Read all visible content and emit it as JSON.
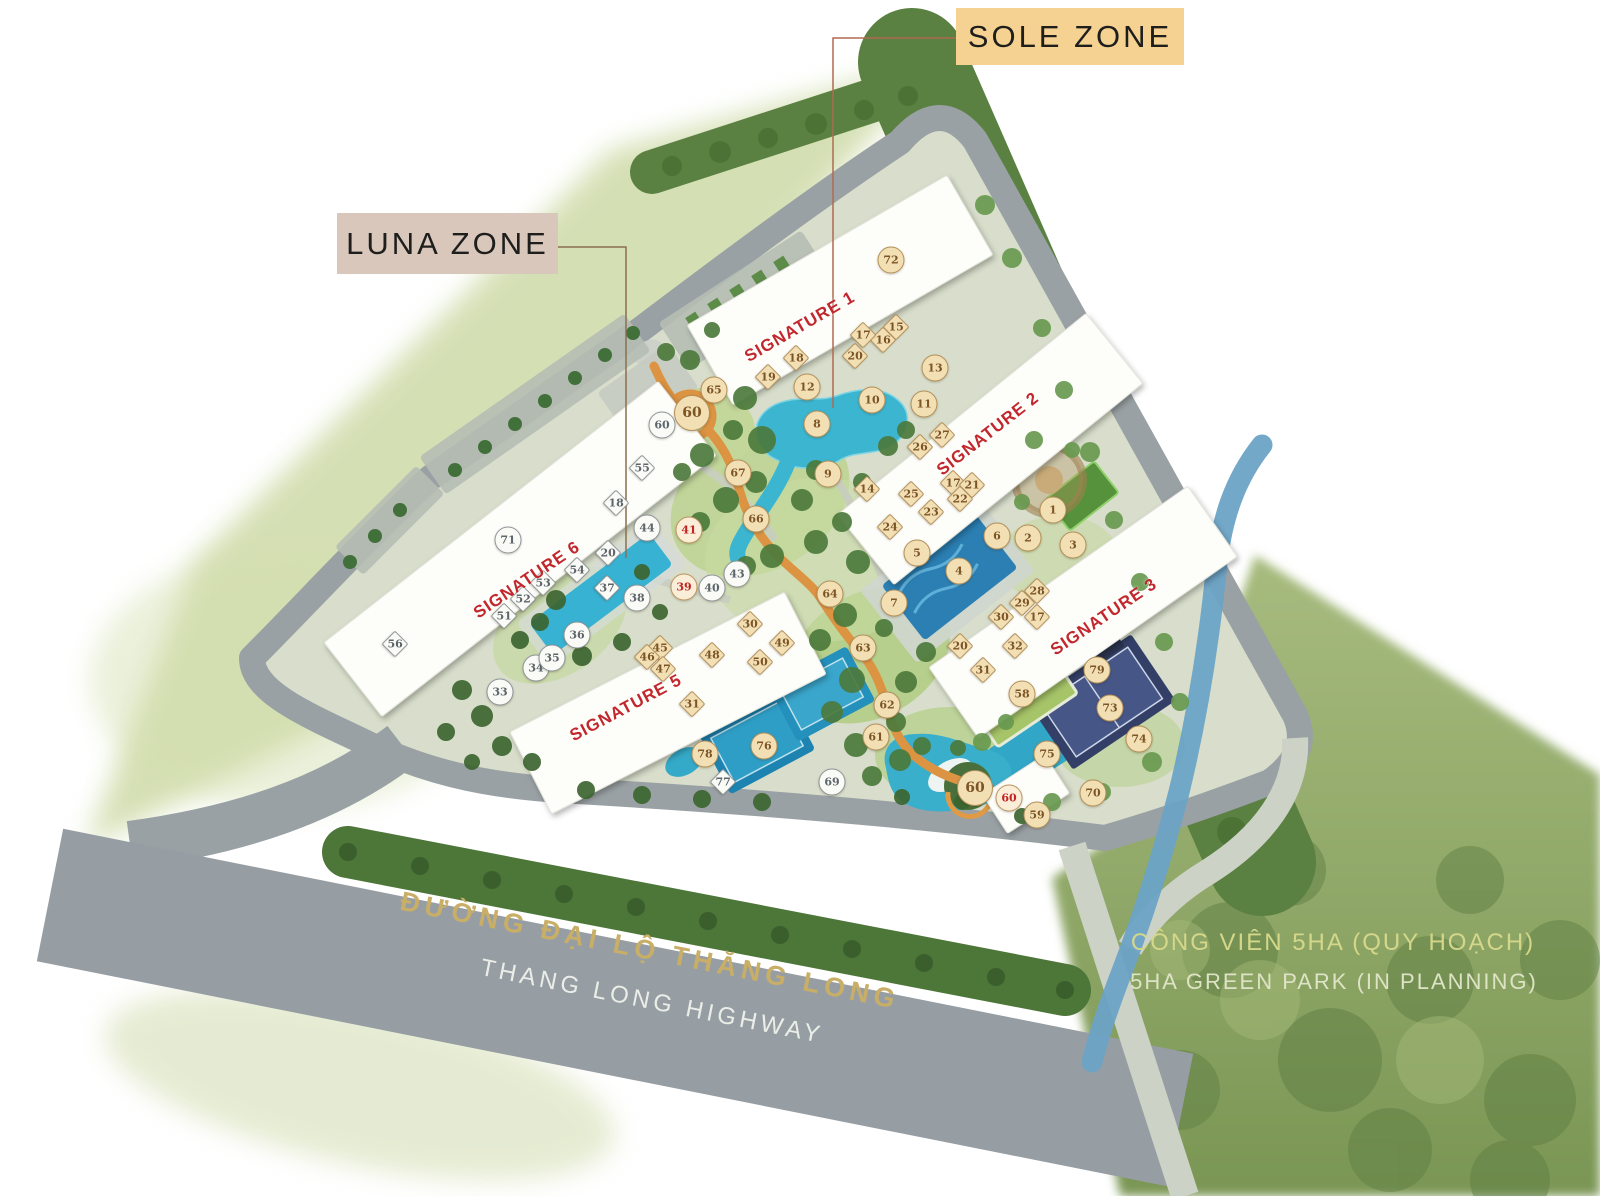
{
  "zones": {
    "sole": "SOLE ZONE",
    "luna": "LUNA ZONE"
  },
  "roads": {
    "highway_vi": "ĐƯỜNG ĐẠI LỘ THĂNG LONG",
    "highway_en": "THANG LONG HIGHWAY"
  },
  "park": {
    "name_vi": "CÔNG VIÊN 5HA (QUY HOẠCH)",
    "name_en": "5HA GREEN PARK (IN PLANNING)"
  },
  "colors": {
    "zone_sole_bg": "#f6d292",
    "zone_luna_bg": "#d9c7bc",
    "signature_red": "#c1272d",
    "road_gold": "#c8ae66",
    "park_text": "#d4d78a",
    "marker_tan": "#f3dfb4",
    "marker_white": "#fafaf7",
    "marker_red_text": "#c32222",
    "track_orange": "#dc9342"
  },
  "building_labels": [
    {
      "text": "SIGNATURE 1",
      "x": 800,
      "y": 327,
      "rot": -30
    },
    {
      "text": "SIGNATURE 2",
      "x": 988,
      "y": 434,
      "rot": -38
    },
    {
      "text": "SIGNATURE 3",
      "x": 1104,
      "y": 617,
      "rot": -34
    },
    {
      "text": "SIGNATURE 5",
      "x": 626,
      "y": 708,
      "rot": -28
    },
    {
      "text": "SIGNATURE 6",
      "x": 527,
      "y": 580,
      "rot": -34
    }
  ],
  "markers": [
    {
      "n": "1",
      "x": 1053,
      "y": 510,
      "s": "c",
      "v": "t"
    },
    {
      "n": "2",
      "x": 1028,
      "y": 538,
      "s": "c",
      "v": "t"
    },
    {
      "n": "3",
      "x": 1073,
      "y": 545,
      "s": "c",
      "v": "t"
    },
    {
      "n": "4",
      "x": 959,
      "y": 571,
      "s": "c",
      "v": "t"
    },
    {
      "n": "5",
      "x": 917,
      "y": 553,
      "s": "c",
      "v": "t"
    },
    {
      "n": "6",
      "x": 997,
      "y": 536,
      "s": "c",
      "v": "t"
    },
    {
      "n": "7",
      "x": 894,
      "y": 603,
      "s": "c",
      "v": "t"
    },
    {
      "n": "8",
      "x": 817,
      "y": 424,
      "s": "c",
      "v": "t"
    },
    {
      "n": "9",
      "x": 828,
      "y": 474,
      "s": "c",
      "v": "t"
    },
    {
      "n": "10",
      "x": 872,
      "y": 400,
      "s": "c",
      "v": "t"
    },
    {
      "n": "11",
      "x": 924,
      "y": 404,
      "s": "c",
      "v": "t"
    },
    {
      "n": "12",
      "x": 807,
      "y": 387,
      "s": "c",
      "v": "t"
    },
    {
      "n": "13",
      "x": 935,
      "y": 368,
      "s": "c",
      "v": "t"
    },
    {
      "n": "58",
      "x": 1022,
      "y": 694,
      "s": "c",
      "v": "t"
    },
    {
      "n": "59",
      "x": 1037,
      "y": 815,
      "s": "c",
      "v": "t"
    },
    {
      "n": "61",
      "x": 876,
      "y": 737,
      "s": "c",
      "v": "t"
    },
    {
      "n": "62",
      "x": 887,
      "y": 705,
      "s": "c",
      "v": "t"
    },
    {
      "n": "63",
      "x": 863,
      "y": 648,
      "s": "c",
      "v": "t"
    },
    {
      "n": "64",
      "x": 830,
      "y": 594,
      "s": "c",
      "v": "t"
    },
    {
      "n": "65",
      "x": 714,
      "y": 390,
      "s": "c",
      "v": "t"
    },
    {
      "n": "66",
      "x": 756,
      "y": 519,
      "s": "c",
      "v": "t"
    },
    {
      "n": "67",
      "x": 738,
      "y": 473,
      "s": "c",
      "v": "t"
    },
    {
      "n": "70",
      "x": 1093,
      "y": 793,
      "s": "c",
      "v": "t"
    },
    {
      "n": "72",
      "x": 891,
      "y": 260,
      "s": "c",
      "v": "t"
    },
    {
      "n": "73",
      "x": 1110,
      "y": 708,
      "s": "c",
      "v": "t"
    },
    {
      "n": "74",
      "x": 1139,
      "y": 739,
      "s": "c",
      "v": "t"
    },
    {
      "n": "75",
      "x": 1047,
      "y": 754,
      "s": "c",
      "v": "t"
    },
    {
      "n": "76",
      "x": 764,
      "y": 746,
      "s": "c",
      "v": "t"
    },
    {
      "n": "78",
      "x": 705,
      "y": 754,
      "s": "c",
      "v": "t"
    },
    {
      "n": "79",
      "x": 1097,
      "y": 670,
      "s": "c",
      "v": "t"
    },
    {
      "n": "60",
      "x": 692,
      "y": 413,
      "s": "c",
      "v": "t",
      "b": true
    },
    {
      "n": "60",
      "x": 975,
      "y": 788,
      "s": "c",
      "v": "t",
      "b": true
    },
    {
      "n": "33",
      "x": 500,
      "y": 692,
      "s": "c",
      "v": "w"
    },
    {
      "n": "34",
      "x": 536,
      "y": 668,
      "s": "c",
      "v": "w"
    },
    {
      "n": "35",
      "x": 552,
      "y": 658,
      "s": "c",
      "v": "w"
    },
    {
      "n": "36",
      "x": 577,
      "y": 635,
      "s": "c",
      "v": "w"
    },
    {
      "n": "38",
      "x": 637,
      "y": 598,
      "s": "c",
      "v": "w"
    },
    {
      "n": "40",
      "x": 712,
      "y": 588,
      "s": "c",
      "v": "w"
    },
    {
      "n": "43",
      "x": 737,
      "y": 574,
      "s": "c",
      "v": "w"
    },
    {
      "n": "44",
      "x": 647,
      "y": 528,
      "s": "c",
      "v": "w"
    },
    {
      "n": "60",
      "x": 662,
      "y": 425,
      "s": "c",
      "v": "w"
    },
    {
      "n": "69",
      "x": 832,
      "y": 782,
      "s": "c",
      "v": "w"
    },
    {
      "n": "71",
      "x": 508,
      "y": 540,
      "s": "c",
      "v": "w"
    },
    {
      "n": "39",
      "x": 684,
      "y": 587,
      "s": "c",
      "v": "r"
    },
    {
      "n": "41",
      "x": 689,
      "y": 530,
      "s": "c",
      "v": "r"
    },
    {
      "n": "60",
      "x": 1009,
      "y": 798,
      "s": "c",
      "v": "r"
    },
    {
      "n": "14",
      "x": 867,
      "y": 489,
      "s": "d",
      "v": "t"
    },
    {
      "n": "15",
      "x": 896,
      "y": 327,
      "s": "d",
      "v": "t"
    },
    {
      "n": "16",
      "x": 883,
      "y": 340,
      "s": "d",
      "v": "t"
    },
    {
      "n": "17",
      "x": 863,
      "y": 335,
      "s": "d",
      "v": "t"
    },
    {
      "n": "17",
      "x": 953,
      "y": 483,
      "s": "d",
      "v": "t"
    },
    {
      "n": "17",
      "x": 1037,
      "y": 617,
      "s": "d",
      "v": "t"
    },
    {
      "n": "18",
      "x": 796,
      "y": 358,
      "s": "d",
      "v": "t"
    },
    {
      "n": "19",
      "x": 768,
      "y": 377,
      "s": "d",
      "v": "t"
    },
    {
      "n": "20",
      "x": 855,
      "y": 356,
      "s": "d",
      "v": "t"
    },
    {
      "n": "20",
      "x": 960,
      "y": 646,
      "s": "d",
      "v": "t"
    },
    {
      "n": "21",
      "x": 972,
      "y": 485,
      "s": "d",
      "v": "t"
    },
    {
      "n": "22",
      "x": 960,
      "y": 499,
      "s": "d",
      "v": "t"
    },
    {
      "n": "23",
      "x": 931,
      "y": 512,
      "s": "d",
      "v": "t"
    },
    {
      "n": "24",
      "x": 890,
      "y": 527,
      "s": "d",
      "v": "t"
    },
    {
      "n": "25",
      "x": 911,
      "y": 494,
      "s": "d",
      "v": "t"
    },
    {
      "n": "26",
      "x": 920,
      "y": 447,
      "s": "d",
      "v": "t"
    },
    {
      "n": "27",
      "x": 942,
      "y": 435,
      "s": "d",
      "v": "t"
    },
    {
      "n": "28",
      "x": 1037,
      "y": 591,
      "s": "d",
      "v": "t"
    },
    {
      "n": "29",
      "x": 1022,
      "y": 603,
      "s": "d",
      "v": "t"
    },
    {
      "n": "30",
      "x": 1001,
      "y": 617,
      "s": "d",
      "v": "t"
    },
    {
      "n": "30",
      "x": 750,
      "y": 624,
      "s": "d",
      "v": "t"
    },
    {
      "n": "31",
      "x": 983,
      "y": 670,
      "s": "d",
      "v": "t"
    },
    {
      "n": "31",
      "x": 692,
      "y": 704,
      "s": "d",
      "v": "t"
    },
    {
      "n": "32",
      "x": 1015,
      "y": 646,
      "s": "d",
      "v": "t"
    },
    {
      "n": "45",
      "x": 660,
      "y": 648,
      "s": "d",
      "v": "t"
    },
    {
      "n": "46",
      "x": 647,
      "y": 657,
      "s": "d",
      "v": "t"
    },
    {
      "n": "47",
      "x": 663,
      "y": 669,
      "s": "d",
      "v": "t"
    },
    {
      "n": "48",
      "x": 712,
      "y": 655,
      "s": "d",
      "v": "t"
    },
    {
      "n": "49",
      "x": 782,
      "y": 643,
      "s": "d",
      "v": "t"
    },
    {
      "n": "50",
      "x": 760,
      "y": 662,
      "s": "d",
      "v": "t"
    },
    {
      "n": "18",
      "x": 616,
      "y": 503,
      "s": "d",
      "v": "w"
    },
    {
      "n": "20",
      "x": 608,
      "y": 553,
      "s": "d",
      "v": "w"
    },
    {
      "n": "37",
      "x": 607,
      "y": 588,
      "s": "d",
      "v": "w"
    },
    {
      "n": "51",
      "x": 504,
      "y": 616,
      "s": "d",
      "v": "w"
    },
    {
      "n": "52",
      "x": 523,
      "y": 599,
      "s": "d",
      "v": "w"
    },
    {
      "n": "53",
      "x": 543,
      "y": 583,
      "s": "d",
      "v": "w"
    },
    {
      "n": "54",
      "x": 577,
      "y": 570,
      "s": "d",
      "v": "w"
    },
    {
      "n": "55",
      "x": 642,
      "y": 468,
      "s": "d",
      "v": "w"
    },
    {
      "n": "56",
      "x": 395,
      "y": 644,
      "s": "d",
      "v": "w"
    },
    {
      "n": "77",
      "x": 723,
      "y": 782,
      "s": "d",
      "v": "w"
    }
  ]
}
